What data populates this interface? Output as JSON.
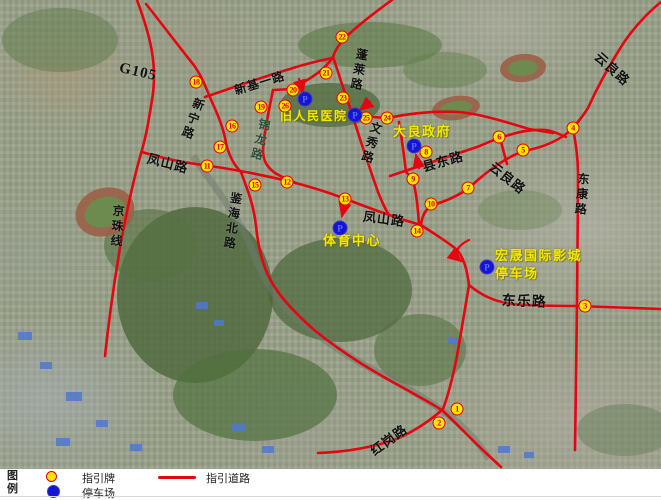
{
  "map": {
    "road_color": "#e60410",
    "sign_color": "#ffe400",
    "parking_color": "#1613d8",
    "parking_letter": "P",
    "roads": [
      "M137,0 C150,35 158,65 152,100 C148,125 146,136 142,150 C134,177 127,210 121,242 C115,277 109,318 105,356",
      "M146,4 C162,24 180,48 193,64 C202,76 206,88 212,102 C219,117 224,130 226,143 C229,156 234,165 241,172",
      "M205,97 C232,88 262,77 290,69 C305,64 318,61 332,58",
      "M392,0 C374,13 356,27 346,37 C339,44 335,50 333,57",
      "M333,57 C327,66 320,72 312,77 C304,82 298,86 292,89 L273,90",
      "M273,90 C269,110 264,133 263,150 C263,161 267,167 275,173 C282,177 288,180 296,183",
      "M333,57 C338,71 342,85 347,99 C352,113 356,127 361,142 C367,160 372,175 378,192 C382,202 385,209 389,215",
      "M142,152 C168,160 188,163 210,166 C238,170 258,174 288,181 C312,187 330,193 346,199 C366,207 386,214 404,220 L421,225",
      "M399,122 C402,139 404,156 406,172 C409,175 411,176 413,180 C416,192 418,207 419,225",
      "M390,176 C417,167 447,157 477,147 C487,143 493,140 500,138 C516,132 531,129 546,130 C553,131 559,134 566,137",
      "M500,138 C503,149 505,157 507,164",
      "M661,2 C646,14 631,31 621,47 C609,66 597,88 588,108 C583,116 578,122 573,128 C561,140 545,147 524,151 C504,158 486,172 469,188 C456,197 444,202 432,205 C426,209 422,216 421,225",
      "M573,128 C576,145 578,158 578,174 C578,218 577,260 577,306 C576,350 576,400 575,450",
      "M421,225 C433,233 445,240 456,249 C464,257 467,270 469,285",
      "M469,285 C481,295 493,301 511,304 C536,306 557,306 578,306 C606,307 633,308 661,309",
      "M469,285 C465,310 461,332 457,356 C453,376 449,393 443,409 C431,420 416,430 399,438 C376,447 346,452 318,453",
      "M241,172 C248,191 254,206 256,226 C258,245 261,259 267,273 C276,293 291,309 313,329 C346,356 376,373 409,391 C421,398 433,404 443,411 C459,426 473,441 487,454 L501,467",
      "M352,116 C364,117 376,117 388,118 C411,113 436,111 459,112 C481,114 506,122 529,129 L553,133"
    ],
    "arrows": [
      "M299,79 L303,93",
      "M370,102 L360,110",
      "M419,168 L416,155",
      "M345,203 L342,216",
      "M469,240 C458,245 452,254 461,261"
    ],
    "road_labels": [
      {
        "text": "G105",
        "x": 121,
        "y": 61,
        "size": 15,
        "rotate": 13,
        "vertical": false,
        "color": "#111111"
      },
      {
        "text": "新宁路",
        "x": 194,
        "y": 96,
        "size": 12,
        "rotate": 20,
        "vertical": true,
        "color": "#111111"
      },
      {
        "text": "新基一路",
        "x": 233,
        "y": 85,
        "size": 12,
        "rotate": -17,
        "vertical": false,
        "color": "#111111"
      },
      {
        "text": "锦龙路",
        "x": 259,
        "y": 117,
        "size": 12,
        "rotate": 14,
        "vertical": true,
        "color": "#2c4f38"
      },
      {
        "text": "蓬莱路",
        "x": 356,
        "y": 47,
        "size": 12,
        "rotate": 10,
        "vertical": true,
        "color": "#111111"
      },
      {
        "text": "文秀路",
        "x": 371,
        "y": 120,
        "size": 12,
        "rotate": 16,
        "vertical": true,
        "color": "#111111"
      },
      {
        "text": "凤山路",
        "x": 149,
        "y": 152,
        "size": 13,
        "rotate": 14,
        "vertical": false,
        "color": "#111111"
      },
      {
        "text": "凤山路",
        "x": 364,
        "y": 210,
        "size": 13,
        "rotate": 7,
        "vertical": false,
        "color": "#111111"
      },
      {
        "text": "县东路",
        "x": 421,
        "y": 161,
        "size": 13,
        "rotate": -16,
        "vertical": false,
        "color": "#111111"
      },
      {
        "text": "云良路",
        "x": 601,
        "y": 50,
        "size": 13,
        "rotate": 42,
        "vertical": false,
        "color": "#111111"
      },
      {
        "text": "云良路",
        "x": 495,
        "y": 160,
        "size": 13,
        "rotate": 38,
        "vertical": false,
        "color": "#111111"
      },
      {
        "text": "东康路",
        "x": 577,
        "y": 172,
        "size": 12,
        "rotate": 5,
        "vertical": true,
        "color": "#111111"
      },
      {
        "text": "东乐路",
        "x": 502,
        "y": 295,
        "size": 14,
        "rotate": 2,
        "vertical": false,
        "color": "#111111"
      },
      {
        "text": "红岗路",
        "x": 368,
        "y": 447,
        "size": 13,
        "rotate": -36,
        "vertical": false,
        "color": "#111111"
      },
      {
        "text": "鉴海北路",
        "x": 230,
        "y": 191,
        "size": 12,
        "rotate": 8,
        "vertical": true,
        "color": "#111111"
      },
      {
        "text": "京珠线",
        "x": 112,
        "y": 204,
        "size": 12,
        "rotate": 4,
        "vertical": true,
        "color": "#111111"
      }
    ],
    "place_labels": [
      {
        "text": "旧人民医院",
        "x": 280,
        "y": 107,
        "size": 12
      },
      {
        "text": "大良政府",
        "x": 393,
        "y": 121,
        "size": 13
      },
      {
        "text": "体育中心",
        "x": 323,
        "y": 230,
        "size": 13
      },
      {
        "text": "宏晟国际影城",
        "x": 495,
        "y": 245,
        "size": 13
      },
      {
        "text": "停车场",
        "x": 495,
        "y": 263,
        "size": 13
      }
    ],
    "signs": [
      {
        "n": "1",
        "x": 457,
        "y": 409
      },
      {
        "n": "2",
        "x": 439,
        "y": 423
      },
      {
        "n": "3",
        "x": 585,
        "y": 306
      },
      {
        "n": "4",
        "x": 573,
        "y": 128
      },
      {
        "n": "5",
        "x": 523,
        "y": 150
      },
      {
        "n": "6",
        "x": 499,
        "y": 137
      },
      {
        "n": "7",
        "x": 468,
        "y": 188
      },
      {
        "n": "8",
        "x": 426,
        "y": 152
      },
      {
        "n": "9",
        "x": 413,
        "y": 179
      },
      {
        "n": "10",
        "x": 431,
        "y": 204
      },
      {
        "n": "11",
        "x": 207,
        "y": 166
      },
      {
        "n": "12",
        "x": 287,
        "y": 182
      },
      {
        "n": "13",
        "x": 345,
        "y": 199
      },
      {
        "n": "14",
        "x": 417,
        "y": 231
      },
      {
        "n": "15",
        "x": 255,
        "y": 185
      },
      {
        "n": "16",
        "x": 232,
        "y": 126
      },
      {
        "n": "17",
        "x": 220,
        "y": 147
      },
      {
        "n": "18",
        "x": 196,
        "y": 82
      },
      {
        "n": "19",
        "x": 261,
        "y": 107
      },
      {
        "n": "20",
        "x": 293,
        "y": 90
      },
      {
        "n": "21",
        "x": 326,
        "y": 73
      },
      {
        "n": "22",
        "x": 342,
        "y": 37
      },
      {
        "n": "23",
        "x": 343,
        "y": 98
      },
      {
        "n": "24",
        "x": 387,
        "y": 118
      },
      {
        "n": "25",
        "x": 366,
        "y": 118
      },
      {
        "n": "26",
        "x": 285,
        "y": 106
      }
    ],
    "parkings": [
      {
        "x": 305,
        "y": 99
      },
      {
        "x": 355,
        "y": 115
      },
      {
        "x": 414,
        "y": 146
      },
      {
        "x": 340,
        "y": 228
      },
      {
        "x": 487,
        "y": 267
      }
    ]
  },
  "legend": {
    "title_line1": "图",
    "title_line2": "例",
    "sign_label": "指引牌",
    "parking_label": "停车场",
    "road_label": "指引道路"
  }
}
